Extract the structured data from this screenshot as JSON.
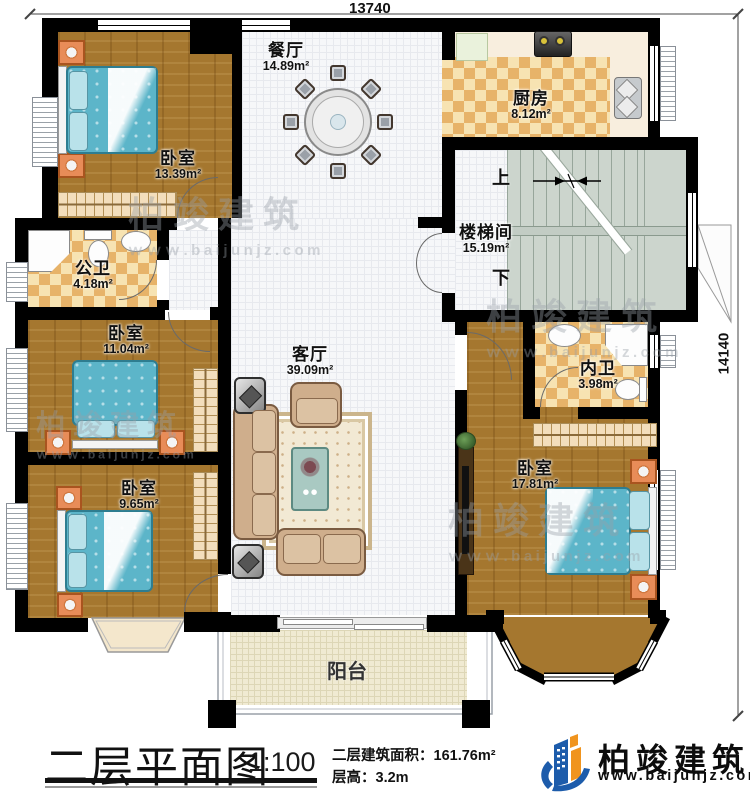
{
  "dimensions": {
    "top": "13740",
    "right": "14140"
  },
  "rooms": {
    "bedroom_tl": {
      "name": "卧室",
      "area": "13.39m²"
    },
    "dining": {
      "name": "餐厅",
      "area": "14.89m²"
    },
    "kitchen": {
      "name": "厨房",
      "area": "8.12m²"
    },
    "stairwell": {
      "name": "楼梯间",
      "area": "15.19m²",
      "up": "上",
      "down": "下"
    },
    "public_bath": {
      "name": "公卫",
      "area": "4.18m²"
    },
    "bedroom_ml": {
      "name": "卧室",
      "area": "11.04m²"
    },
    "living": {
      "name": "客厅",
      "area": "39.09m²"
    },
    "inner_bath": {
      "name": "内卫",
      "area": "3.98m²"
    },
    "bedroom_bl": {
      "name": "卧室",
      "area": "9.65m²"
    },
    "bedroom_br": {
      "name": "卧室",
      "area": "17.81m²"
    },
    "balcony": {
      "name": "阳台"
    }
  },
  "title_block": {
    "title": "二层平面图",
    "scale": "1:100",
    "area_label": "二层建筑面积：",
    "area_value": "161.76m²",
    "floor_height_label": "层高：",
    "floor_height_value": "3.2m"
  },
  "brand": {
    "name": "柏竣建筑",
    "website": "www.baijunjz.com"
  },
  "watermark": {
    "name": "柏竣建筑",
    "website": "ｗｗｗ.baijunjz.com"
  },
  "colors": {
    "wall": "#000000",
    "bed": "#5cb5c9",
    "brand_blue": "#1d5cab",
    "brand_orange": "#f0941e"
  }
}
